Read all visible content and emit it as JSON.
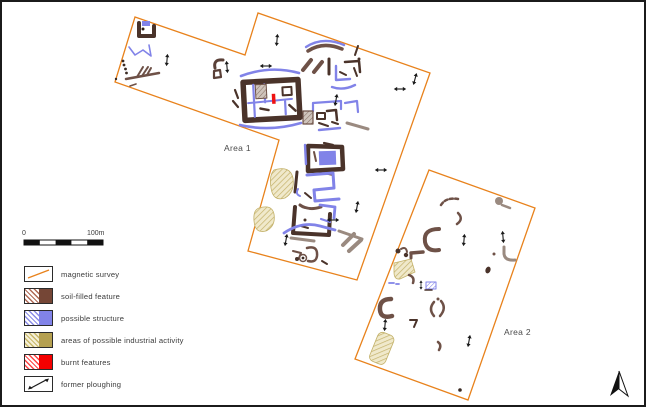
{
  "figure": {
    "type": "archaeological geophysical survey plan",
    "background": "#ffffff",
    "border_color": "#1b1b1b"
  },
  "areas": [
    {
      "id": "area-1",
      "label": "Area 1"
    },
    {
      "id": "area-2",
      "label": "Area 2"
    }
  ],
  "scale_bar": {
    "start_label": "0",
    "end_label": "100m"
  },
  "legend": {
    "items": [
      {
        "label": "magnetic survey",
        "swatch": "orange-diagonal-line"
      },
      {
        "label": "soil-filled feature",
        "swatch": "brown-hatch-and-solid"
      },
      {
        "label": "possible structure",
        "swatch": "blue-hatch-and-solid"
      },
      {
        "label": "areas of possible industrial activity",
        "swatch": "khaki-hatch-and-solid"
      },
      {
        "label": "burnt features",
        "swatch": "red-hatch-and-solid"
      },
      {
        "label": "former ploughing",
        "swatch": "double-headed-arrow"
      }
    ]
  },
  "compass": {
    "name": "north-arrow"
  },
  "colors": {
    "survey_outline_orange": "#e8821c",
    "soil_feature_brown_dark": "#4a332a",
    "soil_feature_brown_mid": "#6e5147",
    "soil_feature_taupe": "#9a8a80",
    "structure_blue": "#8183e8",
    "industrial_khaki": "#b5a050",
    "industrial_khaki_light": "#f0e9cb",
    "burnt_red": "#ee1212",
    "plough_arrow_black": "#1a1a1a"
  }
}
